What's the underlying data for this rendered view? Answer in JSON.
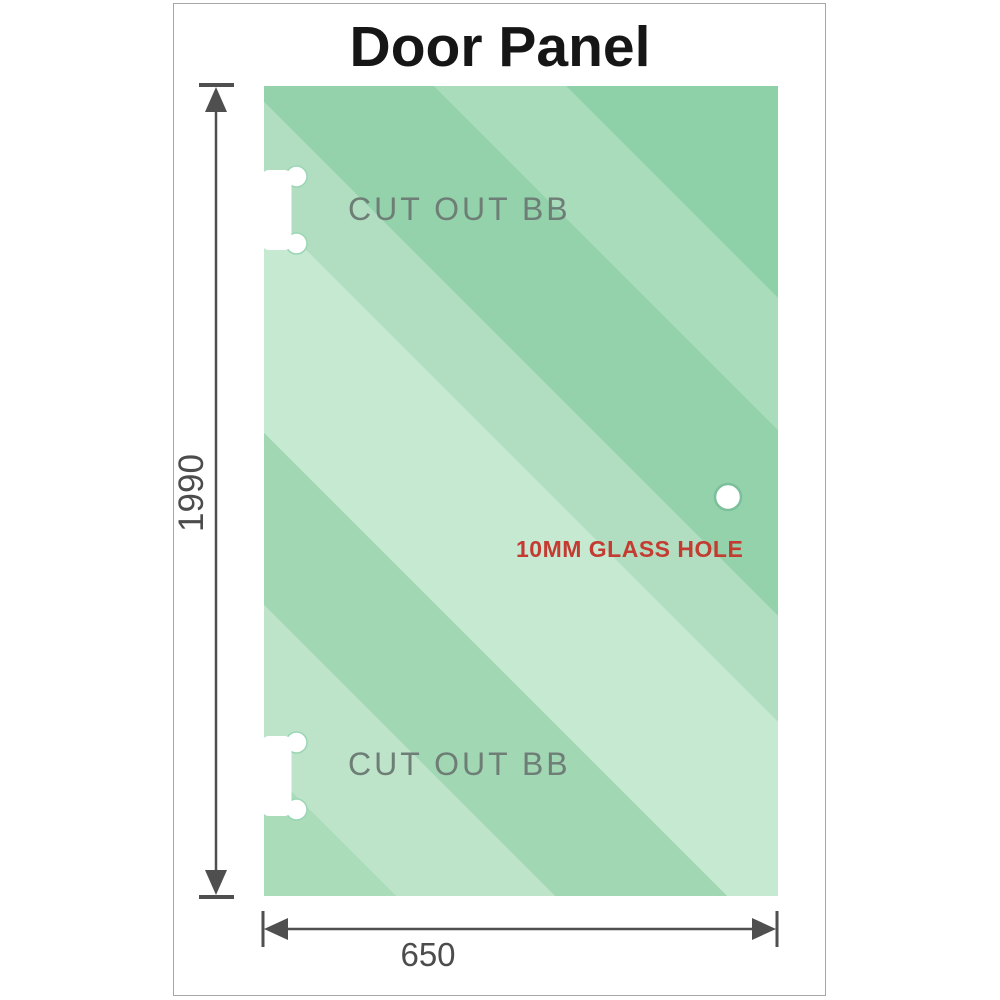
{
  "title": "Door Panel",
  "panel": {
    "cutouts": [
      {
        "label": "CUT OUT BB"
      },
      {
        "label": "CUT OUT BB"
      }
    ],
    "glass_hole_label": "10MM GLASS HOLE"
  },
  "dimensions": {
    "height": "1990",
    "width": "650"
  },
  "colors": {
    "glass_base": "#a8dcba",
    "glass_light_band": "#c6e9d2",
    "glass_dark_band": "#8ed0a7",
    "cutout_label_gray": "#6e7e77",
    "hole_label_red": "#c43b32",
    "dimension_gray": "#4f4f4f",
    "frame_border": "#a6a6a6",
    "title_black": "#161616"
  }
}
